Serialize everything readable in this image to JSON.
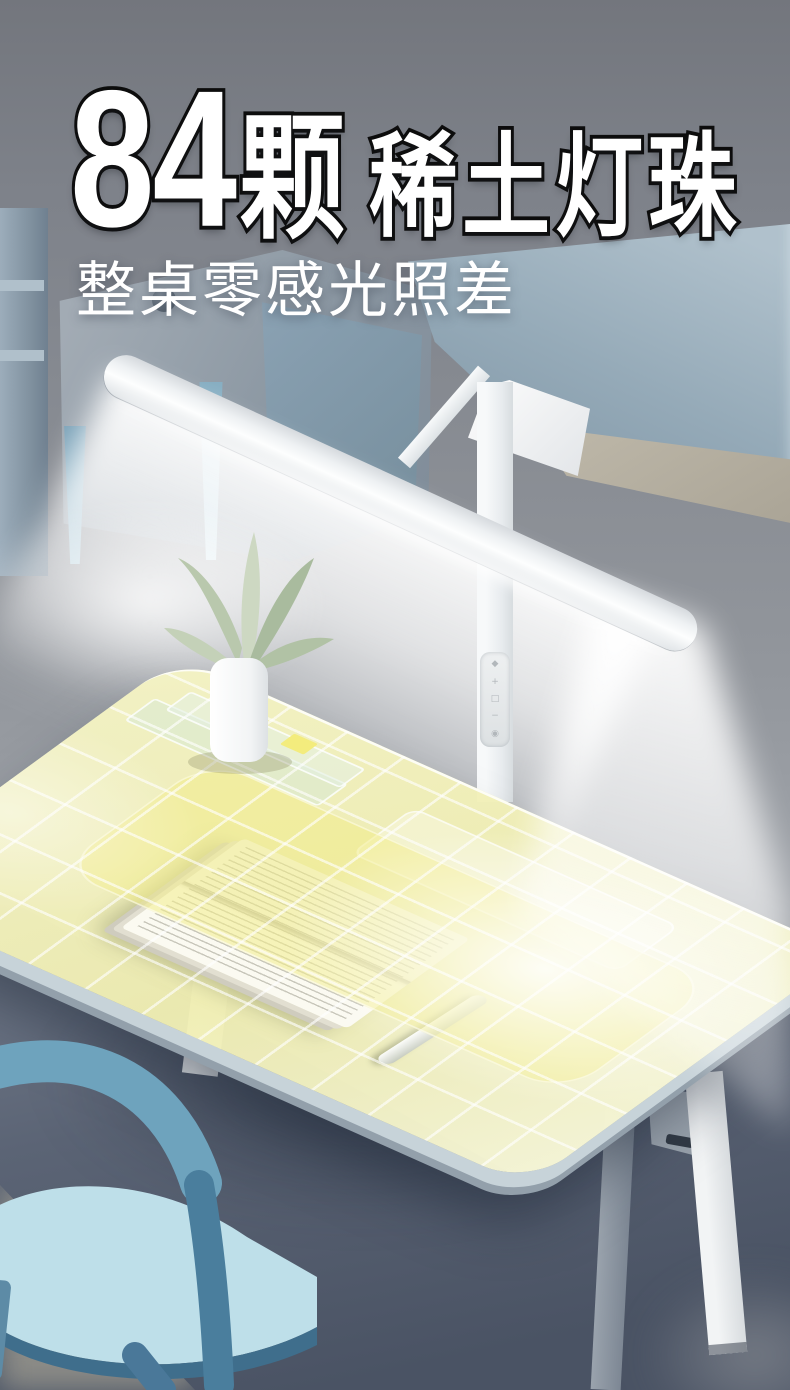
{
  "headline": {
    "count": "84",
    "unit": "颗",
    "feature": "稀土灯珠"
  },
  "subtitle": {
    "text": "整桌零感光照差"
  },
  "lamp": {
    "name": "LED light-bar desk lamp",
    "control_icons": [
      {
        "name": "auto-mode-icon",
        "glyph": "◆"
      },
      {
        "name": "brightness-up-icon",
        "glyph": "+"
      },
      {
        "name": "scene-mode-icon",
        "glyph": "□"
      },
      {
        "name": "brightness-down-icon",
        "glyph": "−"
      },
      {
        "name": "power-icon",
        "glyph": "◉"
      }
    ]
  },
  "colors": {
    "wall_gray": "#83878e",
    "light_zone_yellow": "#f1efae",
    "grid_line_white": "#ffffff",
    "chair_blue": "#76a9c1",
    "floor_shadow": "#545d6e",
    "lamp_body_white": "#f2f4f6"
  }
}
